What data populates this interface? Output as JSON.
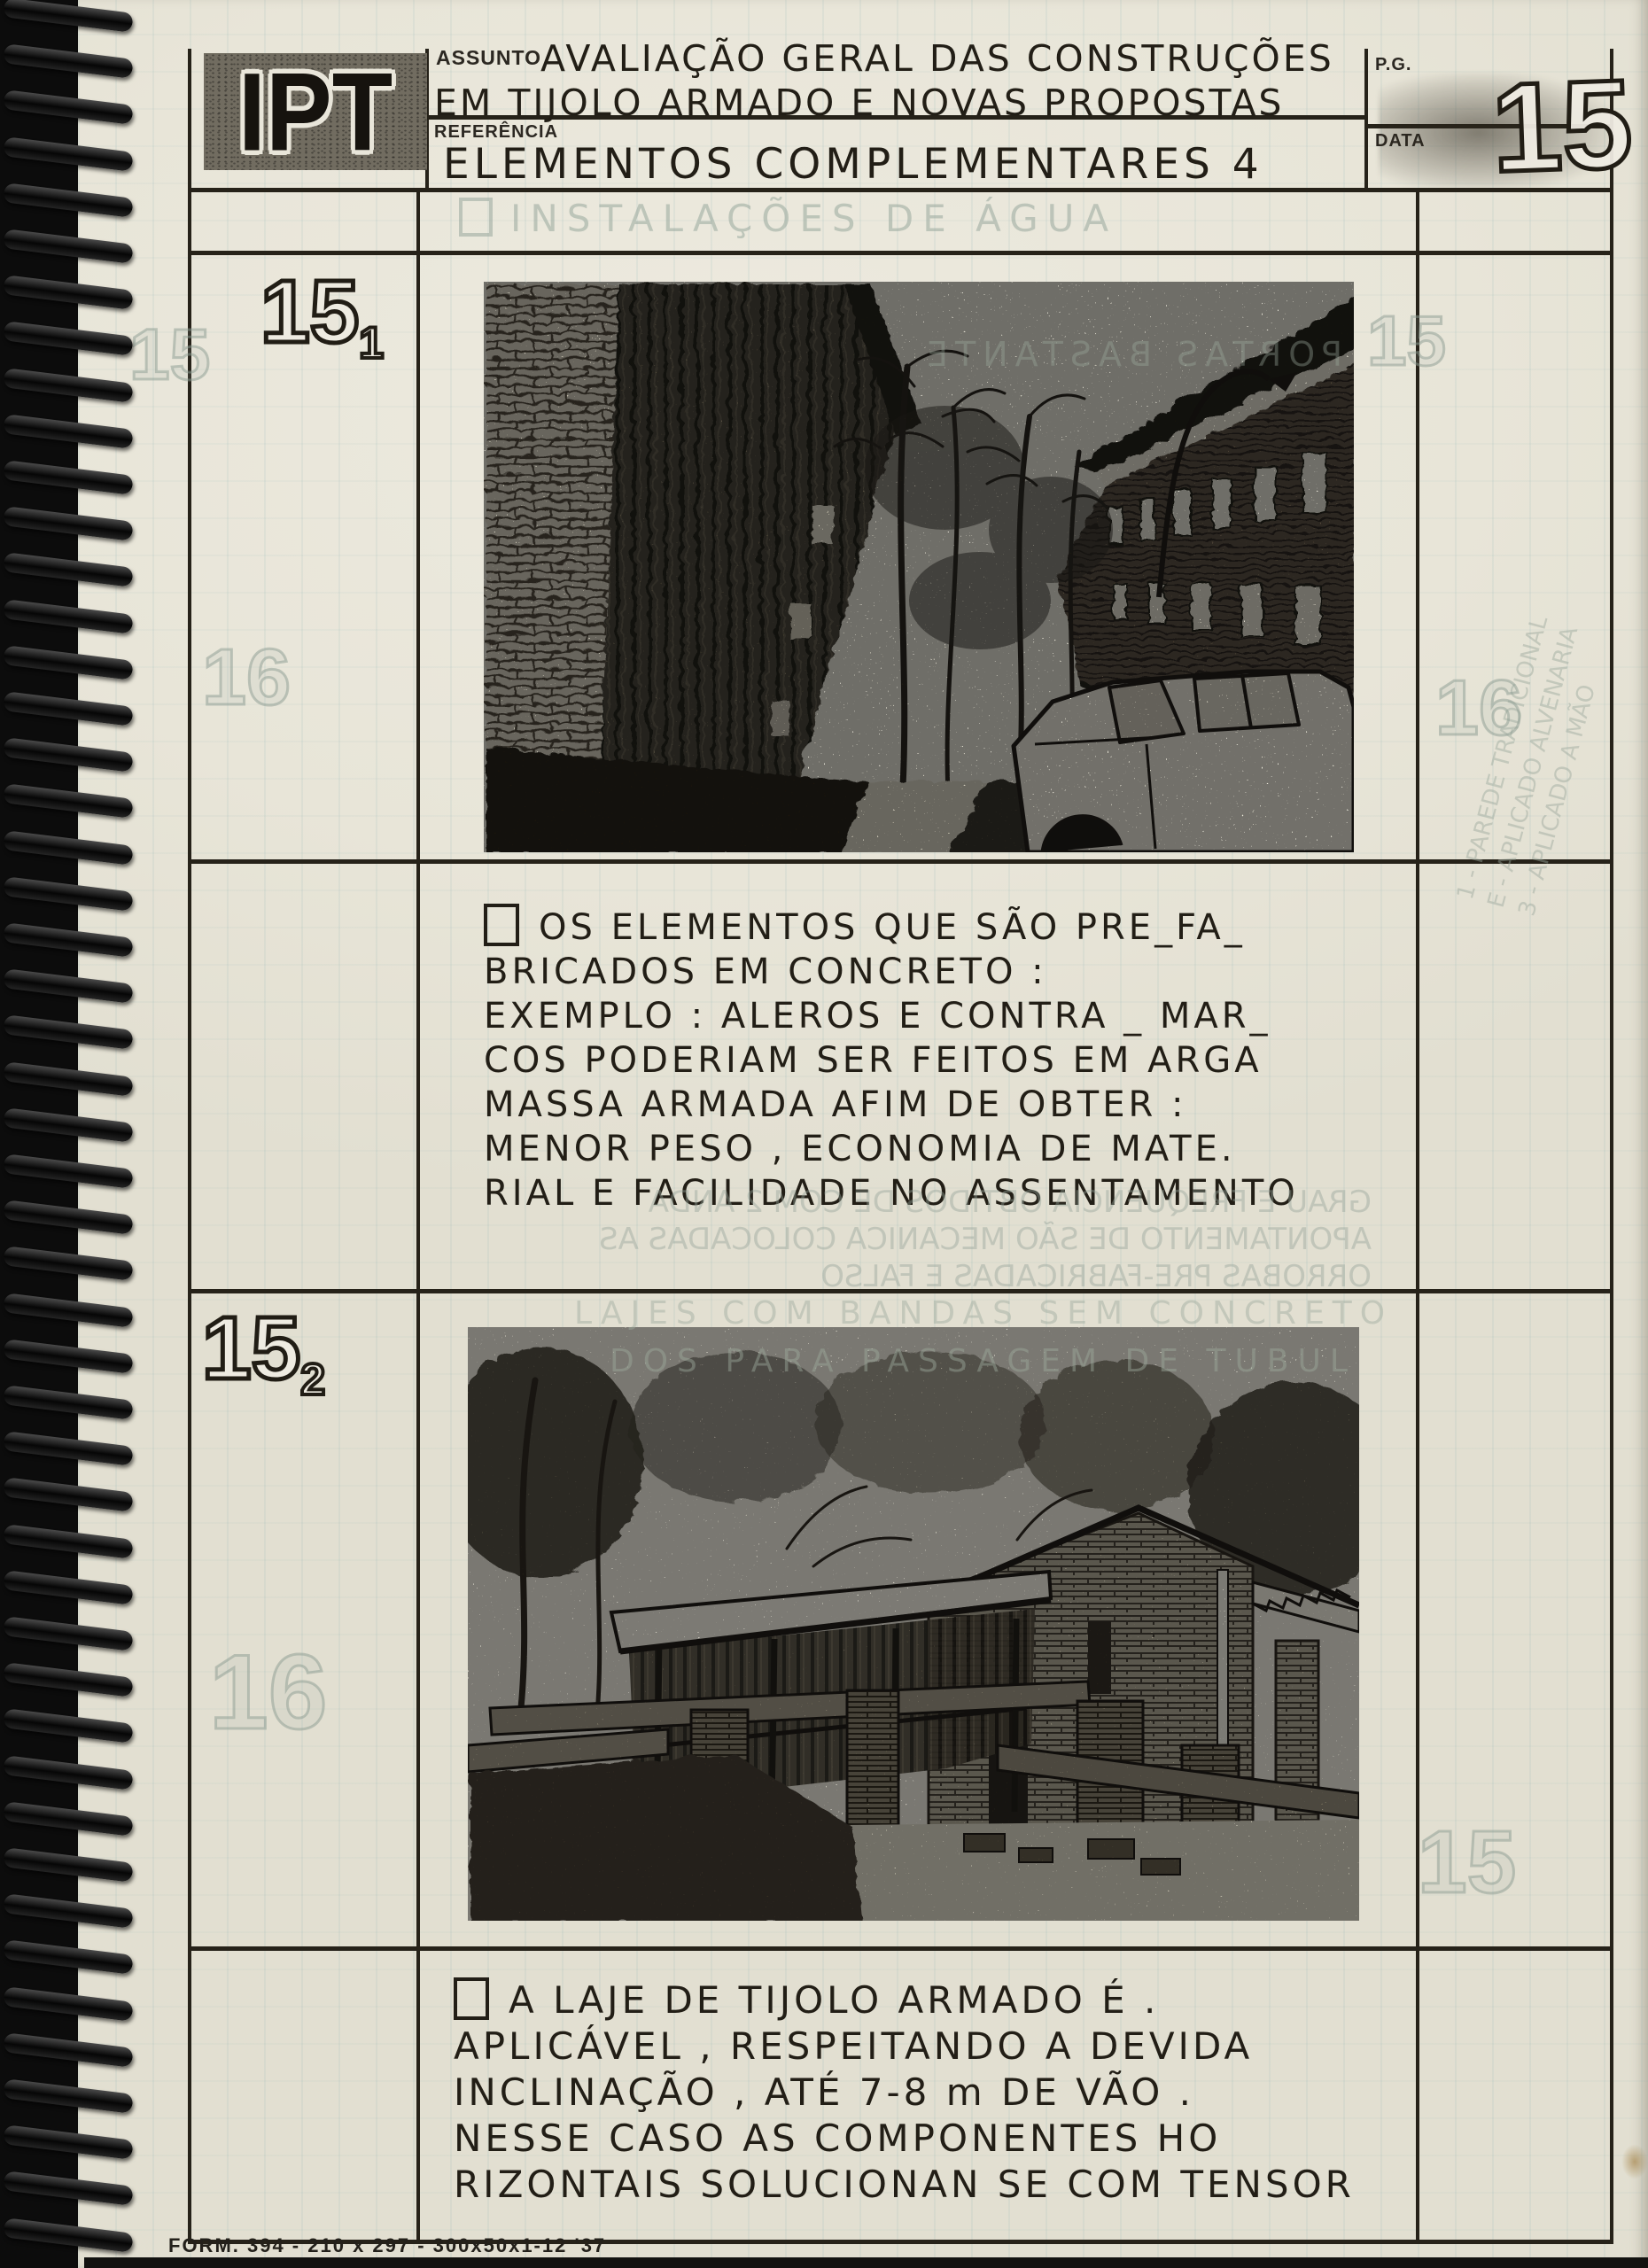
{
  "colors": {
    "paper": "#e9e6da",
    "ink": "#221e16",
    "table_line": "#262219",
    "binding": "#0c0c0c",
    "ghost": "#98a79c",
    "stamp_background": "#716c60"
  },
  "header": {
    "logo_text": "IPT",
    "assunto_label": "ASSUNTO",
    "assunto_line1": "AVALIAÇÃO GERAL DAS CONSTRUÇÕES",
    "assunto_line2": "EM TIJOLO ARMADO E NOVAS PROPOSTAS",
    "referencia_label": "REFERÊNCIA",
    "referencia_value": "ELEMENTOS COMPLEMENTARES 4",
    "pg_label": "P.G.",
    "data_label": "DATA",
    "page_number": "15"
  },
  "section1": {
    "num": "15",
    "sub": "1"
  },
  "section2": {
    "num": "15",
    "sub": "2"
  },
  "text1": {
    "lines": [
      "OS ELEMENTOS QUE SÃO PRE_FA_",
      "BRICADOS EM CONCRETO :",
      "EXEMPLO : ALEROS E CONTRA _ MAR_",
      "COS PODERIAM SER FEITOS EM ARGA",
      "MASSA ARMADA AFIM DE OBTER :",
      "MENOR PESO , ECONOMIA DE MATE.",
      "RIAL E FACILIDADE NO ASSENTAMENTO"
    ]
  },
  "text2": {
    "lines": [
      "A LAJE DE TIJOLO ARMADO É .",
      "APLICÁVEL , RESPEITANDO A DEVIDA",
      "INCLINAÇÃO , ATÉ 7-8 m DE VÃO .",
      "NESSE CASO AS COMPONENTES HO",
      "RIZONTAIS SOLUCIONAN SE COM TENSOR"
    ]
  },
  "footer": {
    "form_text": "FORM. 394 - 210 x 297 - 300x50x1-12  '37"
  },
  "ghosts": {
    "water_title": "INSTALAÇÕES DE ÁGUA",
    "num_15_left": "15",
    "num_16_left": "16",
    "num_16_left_big": "16",
    "num_15_right": "15",
    "num_16_right": "16",
    "num_15_right_low": "15",
    "photo1_line1": "PORTAS BASTANTE",
    "mid_line1": "GRAU E FREQUENCIA OBTIDOS DE COM 2 ANDA",
    "mid_line2": "APONTAMENTO DE SÃO MECANICA COLOCADAS AS",
    "mid_line3": "ORROBAS PRE-FABRICADAS E FALSO",
    "photo2_line1": "LAJES COM BANDAS SEM CONCRETO",
    "photo2_line2": "DOS PARA PASSAGEM DE TUBUL",
    "vert_line1": "1 - PAREDE TRADICIONAL",
    "vert_line2": "E - APLICADO ALVENARIA",
    "vert_line3": "3 - APLICADO A MÃO"
  }
}
